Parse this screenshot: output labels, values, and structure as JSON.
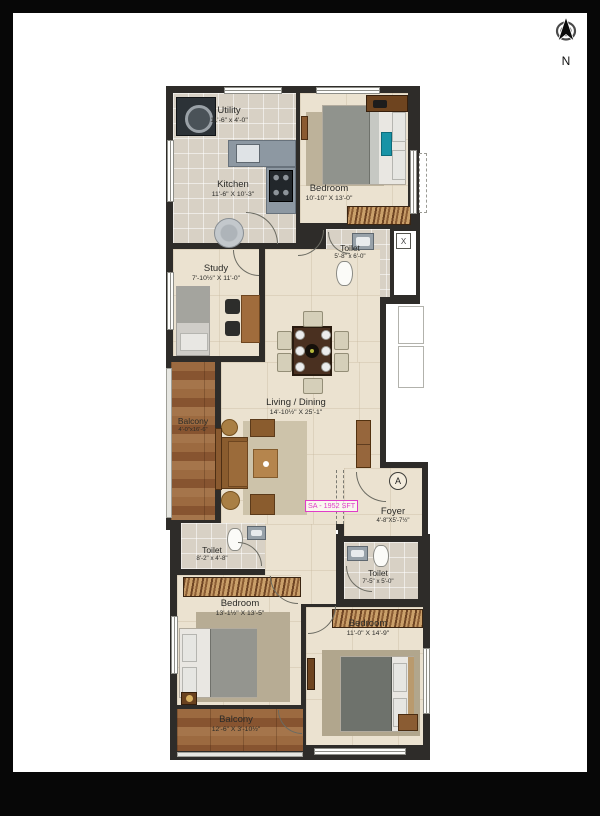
{
  "page": {
    "north_label": "N",
    "area_label": "SA - 1952 SFT",
    "entry_marker": "A",
    "shaft_mark": "X"
  },
  "rooms": {
    "utility": {
      "name": "Utility",
      "dims": "11'-6\" x 4'-0\""
    },
    "kitchen": {
      "name": "Kitchen",
      "dims": "11'-6\" X 10'-3\""
    },
    "bedroom_top": {
      "name": "Bedroom",
      "dims": "10'-10\" X 13'-0\""
    },
    "toilet_top": {
      "name": "Toilet",
      "dims": "5'-8\" x 6'-0\""
    },
    "study": {
      "name": "Study",
      "dims": "7'-10½\" X 11'-0\""
    },
    "living_dining": {
      "name": "Living / Dining",
      "dims": "14'-10½\" X 25'-1\""
    },
    "balcony_left": {
      "name": "Balcony",
      "dims": "4'-0\"x16'-6\""
    },
    "foyer": {
      "name": "Foyer",
      "dims": "4'-8\"X5'-7½\""
    },
    "toilet_left": {
      "name": "Toilet",
      "dims": "8'-2\" x 4'-8\""
    },
    "toilet_right": {
      "name": "Toilet",
      "dims": "7'-5\" x 5'-0\""
    },
    "bedroom_left": {
      "name": "Bedroom",
      "dims": "13'-1½\" X 13'-5\""
    },
    "bedroom_right": {
      "name": "Bedroom",
      "dims": "11'-0\" X 14'-9\""
    },
    "balcony_bottom": {
      "name": "Balcony",
      "dims": "12'-6\" X 3'-10½\""
    }
  },
  "colors": {
    "wall": "#2e2c29",
    "floor": "#ebe2d0",
    "tile": "#d8d1c5",
    "wood": "#9c6a40",
    "area_accent": "#e03cc8"
  }
}
